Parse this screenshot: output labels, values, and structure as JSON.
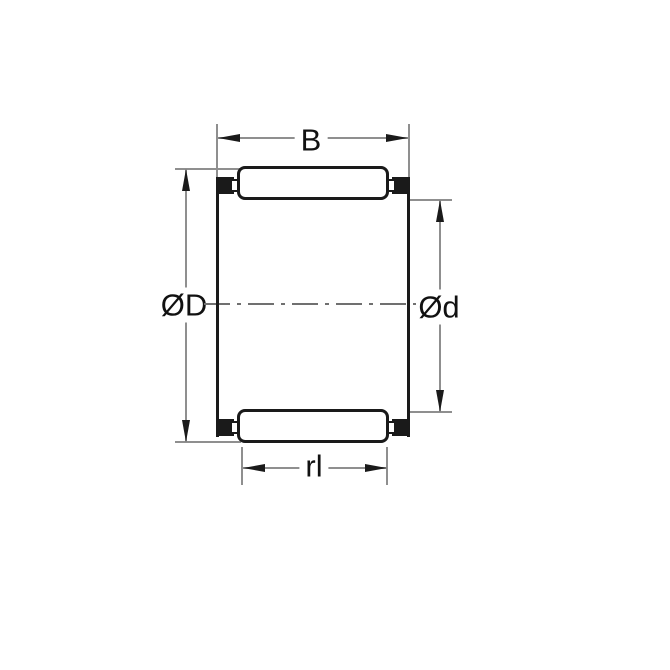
{
  "drawing": {
    "type": "needle-roller-cage-bearing-cross-section",
    "labels": {
      "width": "B",
      "outer_diameter": "ØD",
      "inner_diameter": "Ød",
      "roller_length": "rl"
    },
    "colors": {
      "outline": "#1a1a1a",
      "dimension_line": "#8f8f8f",
      "centerline": "#707070",
      "text": "#111111",
      "background": "#ffffff"
    }
  }
}
